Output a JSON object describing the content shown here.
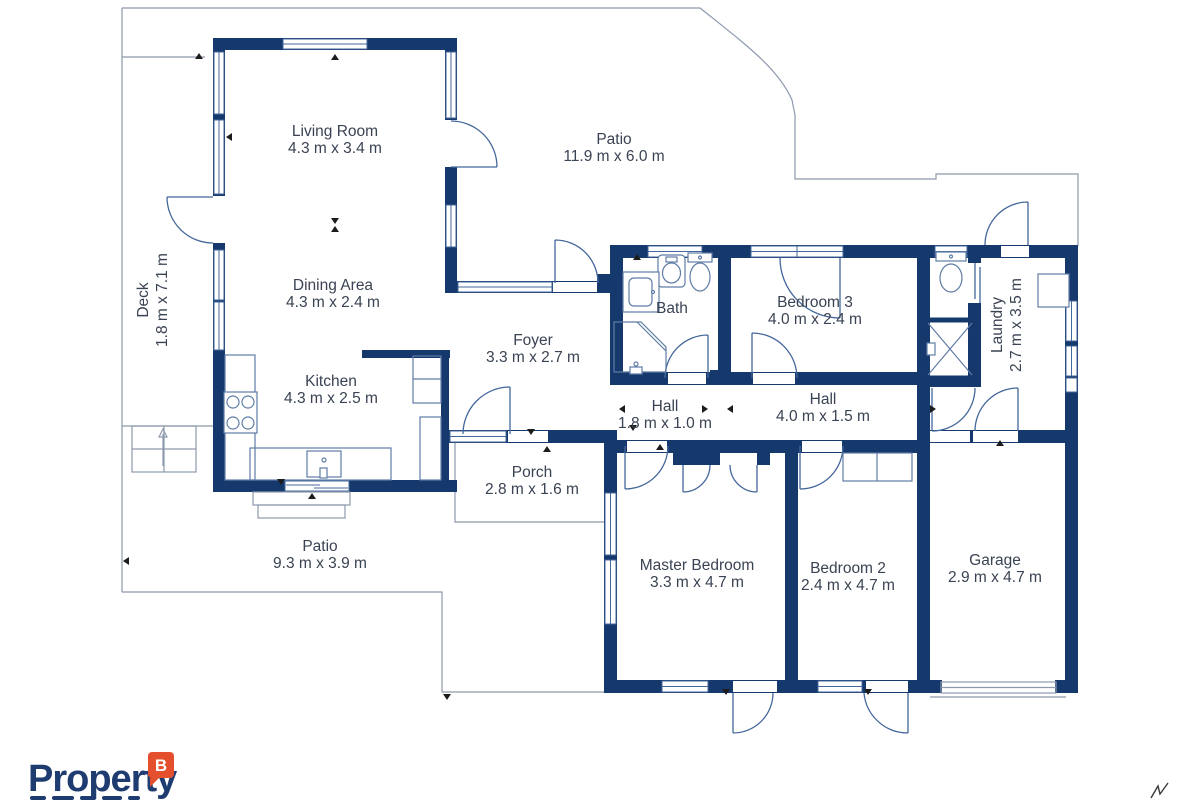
{
  "page": {
    "background": "#ffffff"
  },
  "palette": {
    "wall_navy": "#16396d",
    "boundary_line": "#8d99ac",
    "door_swing": "#44679b",
    "fixture_outline": "#5f7ca6",
    "label_text": "#3a4353",
    "logo_navy": "#1e3c6f",
    "logo_badge_orange": "#e4502e"
  },
  "branding": {
    "logo_text": "Property",
    "badge_letter": "B"
  },
  "rooms": {
    "living_room": {
      "name": "Living Room",
      "dims": "4.3 m x 3.4 m"
    },
    "patio_top": {
      "name": "Patio",
      "dims": "11.9 m x 6.0 m"
    },
    "deck": {
      "name": "Deck",
      "dims": "1.8 m x 7.1 m"
    },
    "dining_area": {
      "name": "Dining Area",
      "dims": "4.3 m x 2.4 m"
    },
    "bath": {
      "name": "Bath",
      "dims": ""
    },
    "bedroom_3": {
      "name": "Bedroom 3",
      "dims": "4.0 m x 2.4 m"
    },
    "laundry": {
      "name": "Laundry",
      "dims": "2.7 m x 3.5 m"
    },
    "foyer": {
      "name": "Foyer",
      "dims": "3.3 m x 2.7 m"
    },
    "kitchen": {
      "name": "Kitchen",
      "dims": "4.3 m x 2.5 m"
    },
    "hall_small": {
      "name": "Hall",
      "dims": "1.8 m x 1.0 m"
    },
    "hall_large": {
      "name": "Hall",
      "dims": "4.0 m x 1.5 m"
    },
    "porch": {
      "name": "Porch",
      "dims": "2.8 m x 1.6 m"
    },
    "patio_bottom": {
      "name": "Patio",
      "dims": "9.3 m x 3.9 m"
    },
    "master_bedroom": {
      "name": "Master Bedroom",
      "dims": "3.3 m x 4.7 m"
    },
    "bedroom_2": {
      "name": "Bedroom 2",
      "dims": "2.4 m x 4.7 m"
    },
    "garage": {
      "name": "Garage",
      "dims": "2.9 m x 4.7 m"
    }
  }
}
